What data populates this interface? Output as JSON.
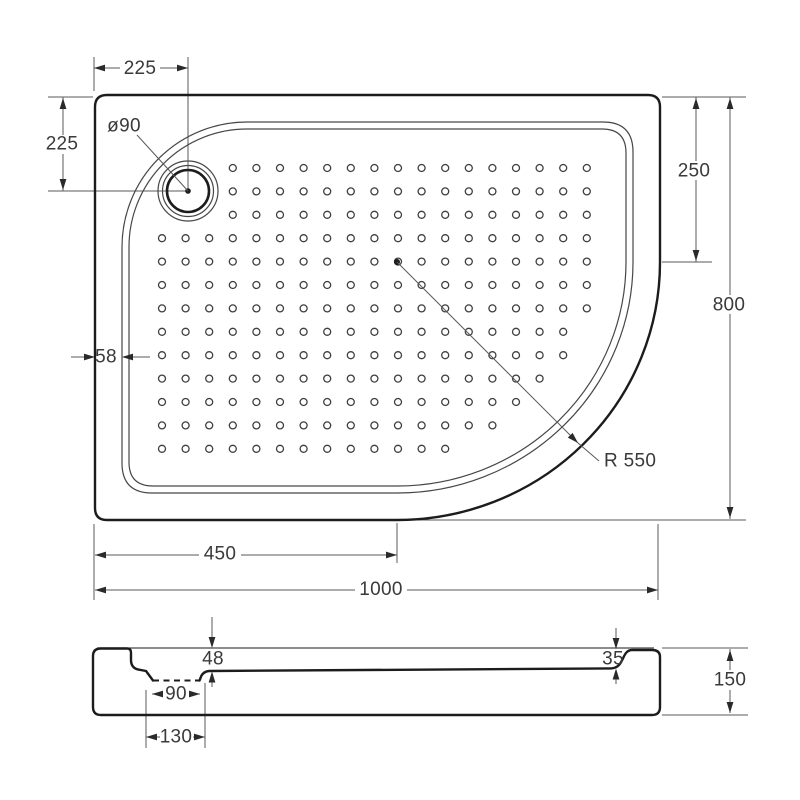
{
  "top_view": {
    "dim_drain_offset_top": "225",
    "dim_drain_offset_left": "225",
    "dim_drain_diameter": "ø90",
    "dim_rim_width": "58",
    "dim_corner_start": "250",
    "dim_height": "800",
    "dim_corner_radius": "R 550",
    "dim_bottom_straight": "450",
    "dim_width": "1000"
  },
  "section_view": {
    "dim_floor_depth_drain": "48",
    "dim_floor_depth_edge": "35",
    "dim_recess_top_width": "90",
    "dim_recess_base_width": "130",
    "dim_total_height": "150"
  }
}
